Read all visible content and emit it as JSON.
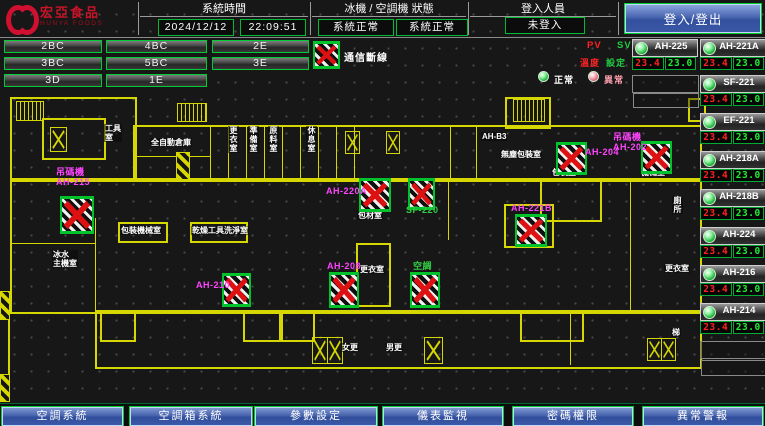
{
  "header": {
    "brand": "宏亞食品",
    "brand_en": "HUNYA FOODS",
    "system_time": {
      "label": "系統時間",
      "date": "2024/12/12",
      "time": "22:09:51"
    },
    "machine_status": {
      "label": "冰機 / 空調機 狀態",
      "chiller": "系統正常",
      "ahu": "系統正常"
    },
    "login": {
      "label": "登入人員",
      "value": "未登入",
      "button": "登入/登出"
    }
  },
  "floor_buttons": [
    "2BC",
    "4BC",
    "2E",
    "3BC",
    "5BC",
    "3E",
    "3D",
    "1E"
  ],
  "legend": {
    "comm_loss": "通信斷線",
    "normal": "正常",
    "abnormal": "異常",
    "pv": "PV",
    "sv": "SV",
    "pv_caption": "溫度",
    "sv_caption": "設定"
  },
  "ahu_panel": {
    "top": [
      {
        "name": "AH-225",
        "pv": "23.4",
        "sv": "23.0"
      },
      {
        "name": "AH-221A",
        "pv": "23.4",
        "sv": "23.0"
      }
    ],
    "rows": [
      {
        "name": "SF-221",
        "pv": "23.4",
        "sv": "23.0"
      },
      {
        "name": "EF-221",
        "pv": "23.4",
        "sv": "23.0"
      },
      {
        "name": "AH-218A",
        "pv": "23.4",
        "sv": "23.0"
      },
      {
        "name": "AH-218B",
        "pv": "23.4",
        "sv": "23.0"
      },
      {
        "name": "AH-224",
        "pv": "23.4",
        "sv": "23.0"
      },
      {
        "name": "AH-216",
        "pv": "23.4",
        "sv": "23.0"
      },
      {
        "name": "AH-214",
        "pv": "23.4",
        "sv": "23.0"
      }
    ]
  },
  "floorplan": {
    "colors": {
      "wall": "#d6d600",
      "marker_x": "#dd1111",
      "label_magenta": "#ff44ff",
      "label_green": "#33cc44"
    },
    "walls": [
      [
        10,
        97,
        123,
        81
      ],
      [
        42,
        118,
        60,
        38
      ],
      [
        133,
        125,
        565,
        53
      ],
      [
        505,
        97,
        42,
        28
      ],
      [
        10,
        178,
        688,
        132
      ],
      [
        95,
        310,
        603,
        55
      ],
      [
        118,
        222,
        46,
        17
      ],
      [
        190,
        222,
        54,
        17
      ],
      [
        356,
        243,
        31,
        60
      ],
      [
        100,
        312,
        32,
        26
      ],
      [
        243,
        312,
        34,
        26
      ],
      [
        281,
        312,
        30,
        26
      ],
      [
        520,
        312,
        60,
        26
      ],
      [
        540,
        180,
        58,
        38
      ],
      [
        688,
        98,
        14,
        20
      ],
      [
        504,
        204,
        46,
        40
      ]
    ],
    "partitions": [
      [
        210,
        127,
        1,
        51
      ],
      [
        228,
        127,
        1,
        51
      ],
      [
        246,
        127,
        1,
        51
      ],
      [
        264,
        127,
        1,
        51
      ],
      [
        282,
        127,
        1,
        51
      ],
      [
        300,
        127,
        1,
        51
      ],
      [
        318,
        127,
        1,
        51
      ],
      [
        336,
        127,
        1,
        51
      ],
      [
        354,
        127,
        1,
        51
      ],
      [
        450,
        127,
        1,
        51
      ],
      [
        476,
        127,
        1,
        51
      ],
      [
        95,
        218,
        1,
        92
      ],
      [
        8,
        310,
        2,
        66
      ],
      [
        133,
        156,
        77,
        1
      ],
      [
        10,
        243,
        85,
        1
      ],
      [
        570,
        312,
        1,
        53
      ],
      [
        448,
        178,
        1,
        62
      ],
      [
        630,
        178,
        1,
        132
      ]
    ],
    "stairs": [
      [
        16,
        101,
        26,
        18
      ],
      [
        177,
        103,
        28,
        17
      ],
      [
        513,
        99,
        30,
        21
      ]
    ],
    "elevators": [
      [
        50,
        127,
        15,
        23
      ],
      [
        345,
        131,
        13,
        21
      ],
      [
        386,
        131,
        12,
        21
      ],
      [
        312,
        337,
        14,
        25
      ],
      [
        327,
        337,
        14,
        25
      ],
      [
        424,
        337,
        17,
        25
      ],
      [
        647,
        338,
        13,
        21
      ],
      [
        661,
        338,
        13,
        21
      ]
    ],
    "hatches": [
      [
        0,
        291,
        8,
        27
      ],
      [
        0,
        374,
        8,
        26
      ],
      [
        176,
        152,
        12,
        26
      ]
    ],
    "markers": [
      {
        "x": 60,
        "y": 196,
        "w": 30,
        "h": 32,
        "label": "吊碼機\nAH-215",
        "lx": 56,
        "ly": 168,
        "lc": "magenta"
      },
      {
        "x": 222,
        "y": 273,
        "w": 25,
        "h": 28,
        "label": "AH-210",
        "lx": 196,
        "ly": 281,
        "lc": "magenta"
      },
      {
        "x": 329,
        "y": 272,
        "w": 26,
        "h": 30,
        "label": "AH-208",
        "lx": 327,
        "ly": 262,
        "lc": "magenta"
      },
      {
        "x": 410,
        "y": 272,
        "w": 26,
        "h": 30,
        "label": "空調",
        "lx": 413,
        "ly": 262,
        "lc": "green"
      },
      {
        "x": 359,
        "y": 178,
        "w": 28,
        "h": 28,
        "label": "AH-220A",
        "lx": 326,
        "ly": 187,
        "lc": "magenta"
      },
      {
        "x": 408,
        "y": 178,
        "w": 23,
        "h": 26,
        "label": "SF-220",
        "lx": 406,
        "ly": 206,
        "lc": "green"
      },
      {
        "x": 515,
        "y": 214,
        "w": 28,
        "h": 27,
        "label": "AH-221B",
        "lx": 511,
        "ly": 204,
        "lc": "magenta"
      },
      {
        "x": 556,
        "y": 142,
        "w": 27,
        "h": 27,
        "label": "AH-204",
        "lx": 585,
        "ly": 148,
        "lc": "magenta"
      },
      {
        "x": 641,
        "y": 141,
        "w": 27,
        "h": 27,
        "label": "吊碼機\nAH-202",
        "lx": 613,
        "ly": 133,
        "lc": "magenta"
      }
    ],
    "rooms": [
      {
        "t": "工具\n室",
        "x": 104,
        "y": 124,
        "v": false
      },
      {
        "t": "全自動倉庫",
        "x": 150,
        "y": 138,
        "v": false
      },
      {
        "t": "更衣室",
        "x": 228,
        "y": 126,
        "v": true
      },
      {
        "t": "準備室",
        "x": 248,
        "y": 126,
        "v": true
      },
      {
        "t": "原料室",
        "x": 268,
        "y": 126,
        "v": true
      },
      {
        "t": "休息室",
        "x": 306,
        "y": 126,
        "v": true
      },
      {
        "t": "AH-B3",
        "x": 481,
        "y": 132,
        "v": false
      },
      {
        "t": "無塵包裝室",
        "x": 500,
        "y": 150,
        "v": false
      },
      {
        "t": "包裝機械室",
        "x": 120,
        "y": 226,
        "v": false
      },
      {
        "t": "乾燥工具洗淨室",
        "x": 191,
        "y": 226,
        "v": false
      },
      {
        "t": "包材室",
        "x": 357,
        "y": 211,
        "v": false
      },
      {
        "t": "更衣室",
        "x": 359,
        "y": 265,
        "v": false
      },
      {
        "t": "包裝室",
        "x": 551,
        "y": 168,
        "v": false
      },
      {
        "t": "機械室",
        "x": 640,
        "y": 168,
        "v": false
      },
      {
        "t": "冰水\n主機室",
        "x": 52,
        "y": 250,
        "v": false
      },
      {
        "t": "女更",
        "x": 341,
        "y": 343,
        "v": false
      },
      {
        "t": "男更",
        "x": 385,
        "y": 343,
        "v": false
      },
      {
        "t": "梯",
        "x": 671,
        "y": 328,
        "v": false
      },
      {
        "t": "廁所",
        "x": 672,
        "y": 196,
        "v": true
      },
      {
        "t": "更衣室",
        "x": 664,
        "y": 264,
        "v": false
      }
    ]
  },
  "bottom_nav": [
    "空調系統",
    "空調箱系統",
    "參數設定",
    "儀表監視",
    "密碼權限",
    "異常警報"
  ]
}
